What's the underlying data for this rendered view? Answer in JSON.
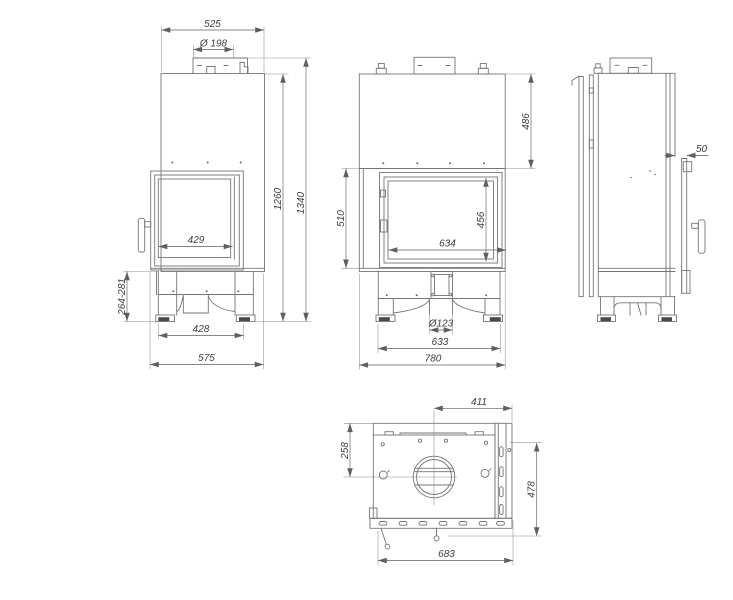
{
  "colors": {
    "background": "#ffffff",
    "geometry_line": "#757575",
    "dimension_line": "#5f5f5f",
    "label_text": "#3c3c3c",
    "foot_pad": "#4a4a4a"
  },
  "views": {
    "side_view": {
      "dims": {
        "top_depth": "525",
        "flue_diameter": "Ø 198",
        "side_glass_width": "429",
        "body_height": "1260",
        "total_height": "1340",
        "base_height_range": "264-281",
        "feet_spacing": "428",
        "total_depth": "575"
      }
    },
    "front_view": {
      "dims": {
        "hood_height": "486",
        "door_height": "510",
        "glass_height": "456",
        "glass_width": "634",
        "inlet_diameter": "Ø123",
        "feet_spacing": "633",
        "total_width": "780"
      }
    },
    "profile_view": {
      "dims": {
        "rear_offset": "50"
      }
    },
    "top_view": {
      "dims": {
        "flue_center_offset": "411",
        "flue_center_from_back": "258",
        "total_depth": "478",
        "total_width": "683"
      }
    }
  }
}
